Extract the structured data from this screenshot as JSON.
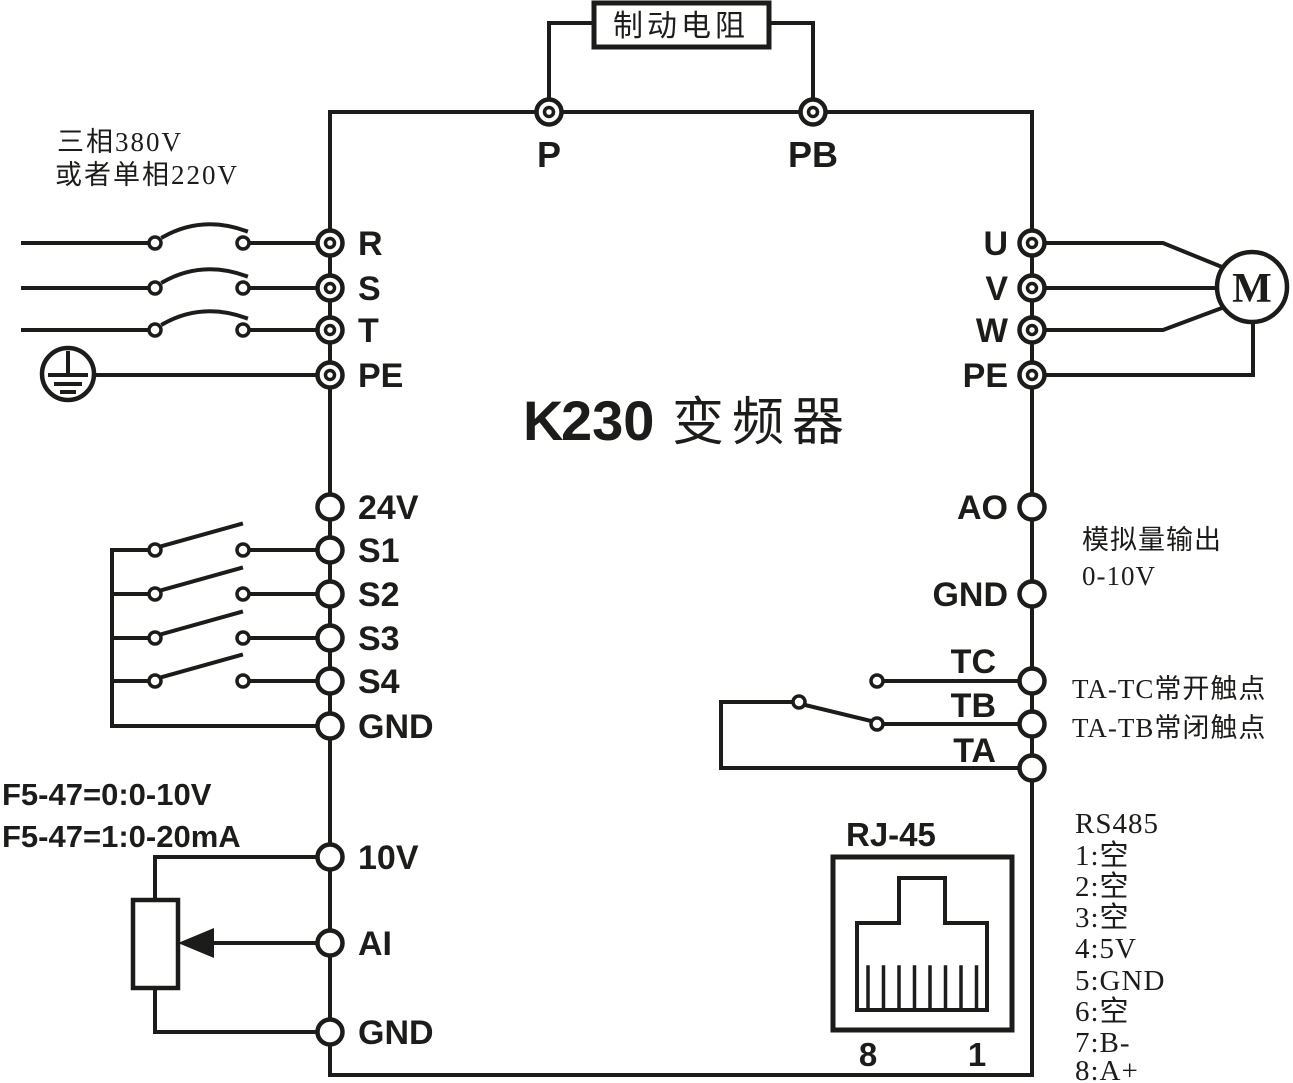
{
  "diagram": {
    "brake": {
      "label": "制动电阻"
    },
    "dc_bus": {
      "p": "P",
      "pb": "PB"
    },
    "power_input": {
      "note_line1": "三相380V",
      "note_line2": "或者单相220V",
      "terminals": [
        "R",
        "S",
        "T",
        "PE"
      ]
    },
    "inverter": {
      "title_k": "K",
      "title_num": "230",
      "title_cn": "变频器"
    },
    "motor_output": {
      "terminals": [
        "U",
        "V",
        "W",
        "PE"
      ],
      "motor_label": "M"
    },
    "digital_inputs": {
      "terminals": [
        "24V",
        "S1",
        "S2",
        "S3",
        "S4",
        "GND"
      ]
    },
    "analog_output": {
      "terminals": [
        "AO",
        "GND"
      ],
      "note_line1": "模拟量输出",
      "note_line2": "0-10V"
    },
    "relay_output": {
      "terminals": [
        "TC",
        "TB",
        "TA"
      ],
      "note_line1": "TA-TC常开触点",
      "note_line2": "TA-TB常闭触点"
    },
    "analog_input": {
      "note_line1": "F5-47=0:0-10V",
      "note_line2": "F5-47=1:0-20mA",
      "terminals": [
        "10V",
        "AI",
        "GND"
      ]
    },
    "rj45": {
      "label": "RJ-45",
      "pin_left": "8",
      "pin_right": "1"
    },
    "rs485": {
      "label": "RS485",
      "pins": [
        "1:空",
        "2:空",
        "3:空",
        "4:5V",
        "5:GND",
        "6:空",
        "7:B-",
        "8:A+"
      ]
    }
  },
  "colors": {
    "ink": "#1c1c1a",
    "background": "#ffffff",
    "highlight": "#ffffff"
  }
}
